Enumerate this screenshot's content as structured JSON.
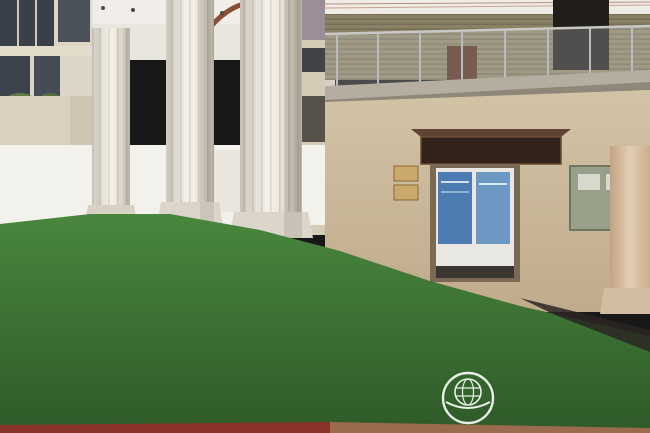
{
  "plaque": {
    "text": "西安翻译学院校史馆",
    "bg": "#33221a",
    "text_color": "#d9a84e"
  },
  "watermark": {
    "zh": "西安翻译学院",
    "en": "XI' AN FANYI UNIVERSITY",
    "abbr": "XFU",
    "color": "#ffffff"
  },
  "colors": {
    "rope": "#9d141f",
    "gold": "#c59c46",
    "model_green": "#3a7134",
    "ceiling_mauve": "#9b8e99"
  },
  "people": {
    "distant": [
      {
        "name": "distant-walker",
        "x": 63,
        "y": 174,
        "shirt": "#ecebe6",
        "pants": "#24242a",
        "s": 0.55
      },
      {
        "name": "distant-visitor",
        "x": 151,
        "y": 198,
        "shirt": "#a05848",
        "pants": "#3a3a3a",
        "s": 0.42
      }
    ],
    "main": [
      {
        "name": "visitor",
        "x": 330,
        "y": 146,
        "shirt": "#8a9096",
        "s": 0.95
      },
      {
        "name": "visitor",
        "x": 347,
        "y": 152,
        "shirt": "#d8d4cb",
        "s": 0.92
      },
      {
        "name": "visitor",
        "x": 385,
        "y": 150,
        "shirt": "#26282e",
        "s": 0.95
      },
      {
        "name": "visitor",
        "x": 405,
        "y": 160,
        "shirt": "#303237",
        "s": 0.95
      },
      {
        "name": "visitor",
        "x": 484,
        "y": 152,
        "shirt": "#70767e",
        "s": 0.92
      },
      {
        "name": "visitor",
        "x": 512,
        "y": 146,
        "shirt": "#273442",
        "s": 0.95
      },
      {
        "name": "visitor",
        "x": 541,
        "y": 154,
        "shirt": "#5d6d7c",
        "s": 0.92
      },
      {
        "name": "visitor",
        "x": 298,
        "y": 164,
        "shirt": "#565a62",
        "legs": 85
      },
      {
        "name": "visitor",
        "x": 322,
        "y": 166,
        "shirt": "#1e79cf",
        "legs": 85
      },
      {
        "name": "visitor",
        "x": 371,
        "y": 159,
        "shirt": "#e2b93d",
        "stripes": "#2c3a6e",
        "legs": 88
      },
      {
        "name": "visitor",
        "x": 427,
        "y": 164,
        "shirt": "#a9c8e8",
        "legs": 95,
        "pants": "#d8d2c4"
      },
      {
        "name": "visitor",
        "x": 464,
        "y": 167,
        "shirt": "#b2906a",
        "legs": 95,
        "pants": "#3a3b40"
      },
      {
        "name": "guide",
        "x": 513,
        "y": 168,
        "shirt": "#f1eee8",
        "lanyard": "#c42634",
        "female": true,
        "pants": "#191a1e",
        "legs": 100
      },
      {
        "name": "visitor",
        "x": 563,
        "y": 164,
        "shirt": "#dfe3e5",
        "strap": true,
        "legs": 95
      },
      {
        "name": "visitor",
        "x": 614,
        "y": 168,
        "shirt": "#e9dede",
        "legs": 105
      },
      {
        "name": "visitor",
        "x": 643,
        "y": 157,
        "shirt": "#c3d4e6",
        "legs": 110
      }
    ]
  },
  "stanchions": {
    "back": {
      "posts": [
        {
          "x": 26,
          "y": 208
        },
        {
          "x": 97,
          "y": 205
        },
        {
          "x": 163,
          "y": 205
        },
        {
          "x": 230,
          "y": 208
        },
        {
          "x": 281,
          "y": 211
        }
      ],
      "sag": 9,
      "h": 22
    },
    "front": {
      "posts": [
        {
          "x": 302,
          "y": 233,
          "h": 34
        },
        {
          "x": 341,
          "y": 236,
          "h": 36
        },
        {
          "x": 401,
          "y": 240,
          "h": 38
        },
        {
          "x": 488,
          "y": 245,
          "h": 50
        },
        {
          "x": 612,
          "y": 248,
          "h": 52
        }
      ],
      "sags": [
        10,
        12,
        16,
        18
      ]
    },
    "near": {
      "posts": [
        {
          "x": 433,
          "y": 280,
          "h": 95,
          "s": 1.3
        },
        {
          "x": 610,
          "y": 347,
          "h": 86,
          "s": 1.5
        }
      ],
      "rope": "M433,286 Q520,334 610,353"
    }
  },
  "sign_stand": {
    "x": 558,
    "y": 241,
    "rot": -7,
    "board": "#a01420",
    "frame": "#c9a24e"
  },
  "model": {
    "glows": [
      {
        "x": 22,
        "y": 258,
        "rx": 26,
        "ry": 10
      },
      {
        "x": 130,
        "y": 306,
        "rx": 40,
        "ry": 8
      },
      {
        "x": 250,
        "y": 304,
        "rx": 46,
        "ry": 8
      },
      {
        "x": 478,
        "y": 300,
        "rx": 48,
        "ry": 8
      },
      {
        "x": 598,
        "y": 324,
        "rx": 44,
        "ry": 8
      },
      {
        "x": 62,
        "y": 320,
        "rx": 34,
        "ry": 8
      }
    ],
    "buildings": [
      {
        "x": 2,
        "y": 236,
        "w": 26,
        "h": 28,
        "c": "#c6bfb4"
      },
      {
        "x": 10,
        "y": 228,
        "w": 12,
        "h": 22,
        "c": "#958b97"
      },
      {
        "x": 28,
        "y": 242,
        "w": 36,
        "h": 13,
        "c": "#a3574b"
      },
      {
        "x": 66,
        "y": 238,
        "w": 26,
        "h": 15,
        "c": "#9b9287"
      },
      {
        "x": 44,
        "y": 250,
        "w": 42,
        "h": 11,
        "c": "#8f8b83"
      },
      {
        "x": 32,
        "y": 256,
        "w": 46,
        "h": 13,
        "c": "#ad6152"
      },
      {
        "x": 0,
        "y": 260,
        "w": 24,
        "h": 20,
        "c": "#b7aba0"
      },
      {
        "x": 96,
        "y": 250,
        "w": 36,
        "h": 11,
        "c": "#c2bbb1"
      },
      {
        "x": 84,
        "y": 260,
        "w": 30,
        "h": 17,
        "c": "#a3564a"
      },
      {
        "x": 146,
        "y": 238,
        "w": 38,
        "h": 12,
        "c": "#c6b6a0"
      },
      {
        "x": 188,
        "y": 243,
        "w": 28,
        "h": 10,
        "c": "#bfb09c"
      },
      {
        "x": 150,
        "y": 250,
        "w": 58,
        "h": 16,
        "c": "#b9a993"
      },
      {
        "x": 106,
        "y": 258,
        "w": 18,
        "h": 38,
        "c": "#ad5749",
        "spire": true
      },
      {
        "x": 124,
        "y": 274,
        "w": 32,
        "h": 20,
        "c": "#a5564c"
      },
      {
        "x": 86,
        "y": 278,
        "w": 36,
        "h": 18,
        "c": "#b25f50"
      },
      {
        "x": 214,
        "y": 256,
        "w": 42,
        "h": 22,
        "c": "#d9d5cb"
      },
      {
        "x": 252,
        "y": 260,
        "w": 84,
        "h": 36,
        "c": "#e7e4db",
        "lit": 3
      },
      {
        "x": 338,
        "y": 248,
        "w": 58,
        "h": 14,
        "c": "#af6a55"
      },
      {
        "x": 344,
        "y": 262,
        "w": 46,
        "h": 18,
        "c": "#a55f4e"
      },
      {
        "x": 390,
        "y": 258,
        "w": 54,
        "h": 16,
        "c": "#d3cfc5",
        "lit": 2
      },
      {
        "x": 396,
        "y": 274,
        "w": 56,
        "h": 14,
        "c": "#b06c57"
      },
      {
        "x": 452,
        "y": 270,
        "w": 52,
        "h": 16,
        "c": "#ccc8be"
      },
      {
        "x": 304,
        "y": 290,
        "w": 120,
        "h": 12,
        "c": "#edebe3"
      },
      {
        "x": 308,
        "y": 298,
        "w": 112,
        "h": 42,
        "c": "#dcd9d0",
        "lit": 4
      },
      {
        "x": 428,
        "y": 286,
        "w": 62,
        "h": 14,
        "c": "#d6d3c9"
      },
      {
        "x": 540,
        "y": 298,
        "w": 38,
        "h": 10,
        "c": "#d0cdc3"
      },
      {
        "x": 0,
        "y": 298,
        "w": 30,
        "h": 30,
        "c": "#d9d6ce"
      },
      {
        "x": 196,
        "y": 340,
        "w": 58,
        "h": 22,
        "c": "#dad8d2"
      },
      {
        "x": 28,
        "y": 328,
        "w": 202,
        "h": 28,
        "c": "#e4e2dc",
        "fence": true
      }
    ],
    "tree_rows": [
      {
        "x": 4,
        "y": 220,
        "dx": 17,
        "n": 12,
        "r": 6,
        "dy": 0.4,
        "c": "#2c5123"
      },
      {
        "x": 196,
        "y": 228,
        "dx": 15,
        "n": 6,
        "r": 5,
        "dy": 1.2,
        "c": "#2c5123"
      },
      {
        "x": 284,
        "y": 246,
        "dx": 15,
        "n": 6,
        "r": 5,
        "dy": 1.6,
        "c": "#30592a"
      },
      {
        "x": 368,
        "y": 260,
        "dx": 16,
        "n": 6,
        "r": 5,
        "dy": 1.8,
        "c": "#2c5123"
      },
      {
        "x": 452,
        "y": 276,
        "dx": 17,
        "n": 7,
        "r": 6,
        "dy": 2.0,
        "c": "#2f5727"
      },
      {
        "x": 560,
        "y": 300,
        "dx": 18,
        "n": 6,
        "r": 6,
        "dy": 2.4,
        "c": "#2c5123"
      },
      {
        "x": 4,
        "y": 322,
        "dx": 19,
        "n": 9,
        "r": 7,
        "dy": 0,
        "c": "#8f7ac2"
      },
      {
        "x": 556,
        "y": 320,
        "dx": 17,
        "n": 6,
        "r": 6,
        "dy": 1.4,
        "c": "#9a86c8"
      },
      {
        "x": 14,
        "y": 360,
        "dx": 22,
        "n": 10,
        "r": 9,
        "dy": 0.6,
        "c": "#3a6a2d"
      },
      {
        "x": 238,
        "y": 366,
        "dx": 22,
        "n": 10,
        "r": 9,
        "dy": 1.4,
        "c": "#3f7131"
      },
      {
        "x": 444,
        "y": 316,
        "dx": 23,
        "n": 9,
        "r": 7,
        "dy": 2.2,
        "c": "#366530"
      },
      {
        "x": 470,
        "y": 338,
        "dx": 24,
        "n": 8,
        "r": 8,
        "dy": 2.0,
        "c": "#3b6c2f"
      },
      {
        "x": 500,
        "y": 362,
        "dx": 26,
        "n": 6,
        "r": 9,
        "dy": 1.6,
        "c": "#346029"
      },
      {
        "x": 6,
        "y": 388,
        "dx": 18,
        "n": 9,
        "r": 8,
        "dy": 0.6,
        "c": "#2f5a28"
      },
      {
        "x": 10,
        "y": 410,
        "dx": 20,
        "n": 8,
        "r": 9,
        "dy": 0.4,
        "c": "#356331"
      },
      {
        "x": 560,
        "y": 396,
        "dx": 24,
        "n": 4,
        "r": 10,
        "dy": 1.0,
        "c": "#2f5a28"
      }
    ],
    "blossoms": [
      {
        "x": 180,
        "y": 356,
        "r": 11
      },
      {
        "x": 214,
        "y": 398,
        "r": 12
      },
      {
        "x": 404,
        "y": 392,
        "r": 9
      },
      {
        "x": 118,
        "y": 404,
        "r": 9
      },
      {
        "x": 96,
        "y": 384,
        "r": 7
      },
      {
        "x": 636,
        "y": 296,
        "r": 6
      }
    ],
    "lamps": [
      {
        "x": 56,
        "y": 300
      },
      {
        "x": 140,
        "y": 398
      },
      {
        "x": 250,
        "y": 342
      },
      {
        "x": 358,
        "y": 378
      },
      {
        "x": 470,
        "y": 352
      },
      {
        "x": 596,
        "y": 388
      },
      {
        "x": 64,
        "y": 330
      },
      {
        "x": 330,
        "y": 312
      },
      {
        "x": 540,
        "y": 330
      },
      {
        "x": 620,
        "y": 360
      }
    ],
    "signs": [
      {
        "x": 246,
        "y": 266
      },
      {
        "x": 362,
        "y": 262
      },
      {
        "x": 540,
        "y": 294
      },
      {
        "x": 132,
        "y": 296
      },
      {
        "x": 466,
        "y": 282
      },
      {
        "x": 58,
        "y": 252
      }
    ],
    "paths": [
      {
        "d": "M24,418 C120,398 210,408 332,424",
        "w": 7,
        "c": "#aaa29a"
      },
      {
        "d": "M8,370 C80,364 160,362 240,364 L420,356",
        "w": 8,
        "c": "#928d84"
      },
      {
        "d": "M300,296 L290,340",
        "w": 4,
        "c": "#a39d94"
      },
      {
        "d": "M452,386 C520,376 580,380 648,392",
        "w": 5,
        "c": "#9e9890"
      },
      {
        "d": "M560,400 L644,378",
        "w": 1.2,
        "c": "#cfe0c8"
      },
      {
        "d": "M578,412 L650,394",
        "w": 1.2,
        "c": "#cfe0c8"
      }
    ],
    "rainbow": {
      "x": 20,
      "y": 400
    }
  }
}
